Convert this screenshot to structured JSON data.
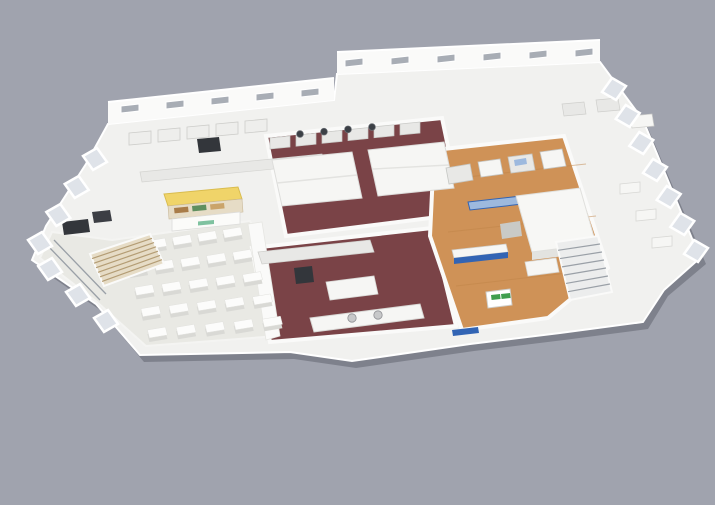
{
  "canvas": {
    "width": 715,
    "height": 505
  },
  "description": "3D isometric cutaway rendering of a food-facility floor plan: dining hall with table grid (left), dark-red floored central kitchens with stainless equipment, wooden-floored production/demo area with blue machinery (right-center), white office wing (right), glass window panels around the perimeter and staircases.",
  "background_color": "#a0a3ae",
  "palette": {
    "shadow": "rgba(62,66,76,0.35)",
    "slab": "#f1f1ef",
    "wall": "#fafaf9",
    "wall_edge": "#e2e2df",
    "floor_light": "#e9e9e4",
    "maroon": "#7a4347",
    "maroon_dark": "#5f3338",
    "wood": "#cf9257",
    "wood_line": "#c08448",
    "glass": "#dfe3e9",
    "window_dark": "#a8adb5",
    "steel": "#e8e8e6",
    "steel_dark": "#c9cac7",
    "dark_equipment": "#33363b",
    "blue": "#3264b4",
    "blue_light": "#9db9de",
    "yellow": "#f0d469",
    "yellow_edge": "#d9bc4e",
    "green": "#3f9e4e",
    "mint": "#7fc2a0",
    "tan_light": "#e6dcc6",
    "stair_wood": "#b49d75",
    "stair_wood_bg": "#e6dcc6",
    "stair_metal": "#9aa0a7",
    "stair_metal_bg": "#eceded",
    "table_top": "#fcfcfb",
    "table_side": "#d9d9d5",
    "table_edge": "#e2e2de",
    "white_unit": "#f6f6f4",
    "sink": "#c7c8c9",
    "railing": "#9aa0a7"
  },
  "zones": [
    {
      "id": "dining-area",
      "floor": "floor_light"
    },
    {
      "id": "central-kitchen-upper",
      "floor": "maroon"
    },
    {
      "id": "central-kitchen-lower",
      "floor": "maroon"
    },
    {
      "id": "production-demo-area",
      "floor": "wood"
    },
    {
      "id": "office-wing",
      "floor": "slab"
    },
    {
      "id": "rear-prep-kitchen",
      "floor": "slab"
    }
  ],
  "scene": {
    "dining_tables": {
      "quad": [
        [
          116,
          240
        ],
        [
          240,
          221
        ],
        [
          292,
          333
        ],
        [
          146,
          346
        ]
      ],
      "rows": 5,
      "cols": 5
    },
    "windows_left": {
      "from": [
        95,
        164
      ],
      "to": [
        40,
        248
      ],
      "count": 4
    },
    "windows_left2": {
      "from": [
        50,
        274
      ],
      "to": [
        106,
        326
      ],
      "count": 3
    },
    "windows_right": {
      "from": [
        614,
        94
      ],
      "to": [
        696,
        256
      ],
      "count": 7
    },
    "rear_windows_a": {
      "from": [
        130,
        110
      ],
      "to": [
        310,
        94
      ],
      "count": 5
    },
    "rear_windows_b": {
      "from": [
        354,
        64
      ],
      "to": [
        584,
        54
      ],
      "count": 6
    },
    "cook_line": {
      "from": [
        280,
        144
      ],
      "to": [
        410,
        130
      ],
      "count": 6
    },
    "woks": {
      "from": [
        300,
        134
      ],
      "to": [
        372,
        127
      ],
      "count": 4
    },
    "fridge_row": {
      "from": [
        140,
        140
      ],
      "to": [
        256,
        128
      ],
      "count": 5
    },
    "bench_row": {
      "from": [
        630,
        190
      ],
      "to": [
        662,
        244
      ],
      "count": 3
    },
    "stairs": [
      {
        "quad": [
          [
            556,
            242
          ],
          [
            598,
            236
          ],
          [
            612,
            292
          ],
          [
            570,
            300
          ]
        ],
        "steps": 7,
        "bg": "stair_metal_bg",
        "stripe": "stair_metal"
      },
      {
        "quad": [
          [
            90,
            254
          ],
          [
            150,
            234
          ],
          [
            164,
            264
          ],
          [
            104,
            286
          ]
        ],
        "steps": 7,
        "bg": "stair_wood_bg",
        "stripe": "stair_wood"
      }
    ]
  }
}
